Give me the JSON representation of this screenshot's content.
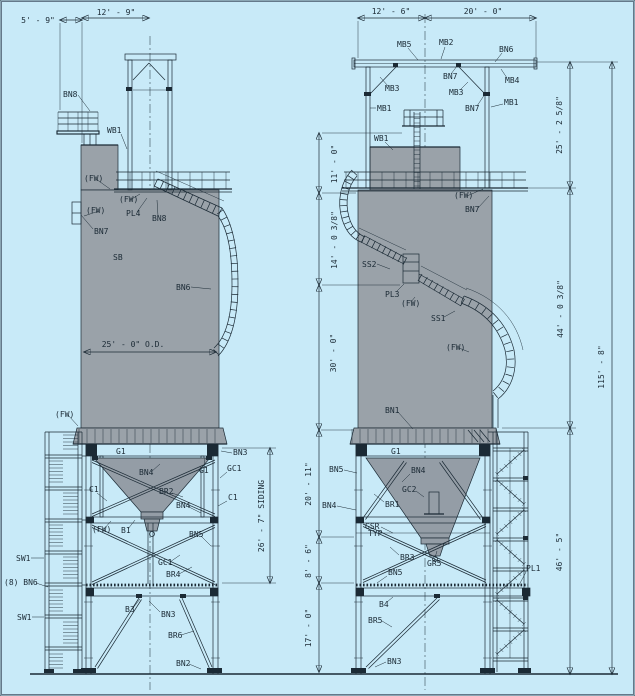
{
  "colors": {
    "background": "#c8eaf8",
    "ink": "#1b2a35",
    "silo_gray": "#9aa2a9",
    "hopper_gray": "#949da6"
  },
  "annotations": [
    {
      "t": "5' - 9\"",
      "x": 38,
      "y": 23,
      "a": "m"
    },
    {
      "t": "12' - 9\"",
      "x": 116,
      "y": 15,
      "a": "m"
    },
    {
      "t": "12' - 6\"",
      "x": 391,
      "y": 14,
      "a": "m"
    },
    {
      "t": "20' - 0\"",
      "x": 483,
      "y": 14,
      "a": "m"
    },
    {
      "t": "BN8",
      "x": 63,
      "y": 97,
      "l": [
        78,
        95,
        90,
        111
      ]
    },
    {
      "t": "WB1",
      "x": 107,
      "y": 133,
      "l": [
        121,
        134,
        127,
        149
      ]
    },
    {
      "t": "(FW)",
      "x": 84,
      "y": 181,
      "s": 6,
      "l": [
        96,
        179,
        110,
        189
      ]
    },
    {
      "t": "(FW)",
      "x": 119,
      "y": 202,
      "s": 6,
      "l": [
        130,
        200,
        140,
        194
      ]
    },
    {
      "t": "PL4",
      "x": 126,
      "y": 216,
      "l": [
        137,
        212,
        147,
        198
      ]
    },
    {
      "t": "BN8",
      "x": 152,
      "y": 221,
      "l": [
        158,
        216,
        157,
        200
      ]
    },
    {
      "t": "(FW)",
      "x": 86,
      "y": 213,
      "s": 6,
      "l": [
        99,
        211,
        84,
        216
      ]
    },
    {
      "t": "BN7",
      "x": 94,
      "y": 234,
      "l": [
        93,
        229,
        81,
        215
      ]
    },
    {
      "t": "SB",
      "x": 113,
      "y": 260
    },
    {
      "t": "BN6",
      "x": 176,
      "y": 290,
      "l": [
        191,
        287,
        211,
        289
      ]
    },
    {
      "t": "25' - 0\" O.D.",
      "x": 133,
      "y": 347,
      "a": "m"
    },
    {
      "t": "G1",
      "x": 116,
      "y": 454
    },
    {
      "t": "BN4",
      "x": 139,
      "y": 475,
      "l": [
        151,
        472,
        160,
        464
      ]
    },
    {
      "t": "G1",
      "x": 199,
      "y": 473,
      "l": [
        204,
        469,
        205,
        458
      ]
    },
    {
      "t": "GC1",
      "x": 227,
      "y": 471,
      "l": [
        227,
        472,
        220,
        478
      ]
    },
    {
      "t": "BN3",
      "x": 233,
      "y": 455,
      "l": [
        232,
        453,
        221,
        451
      ]
    },
    {
      "t": "C1",
      "x": 89,
      "y": 492,
      "l": [
        97,
        493,
        107,
        501
      ]
    },
    {
      "t": "BR2",
      "x": 159,
      "y": 494,
      "l": [
        172,
        493,
        183,
        497
      ]
    },
    {
      "t": "C1",
      "x": 228,
      "y": 500,
      "l": [
        227,
        501,
        218,
        506
      ]
    },
    {
      "t": "BN4",
      "x": 176,
      "y": 508,
      "l": [
        189,
        507,
        201,
        513
      ]
    },
    {
      "t": "(FW)",
      "x": 92,
      "y": 532,
      "s": 6,
      "l": [
        104,
        529,
        111,
        521
      ]
    },
    {
      "t": "B1",
      "x": 121,
      "y": 533,
      "l": [
        128,
        529,
        135,
        520
      ]
    },
    {
      "t": "BN5",
      "x": 189,
      "y": 537,
      "l": [
        201,
        536,
        211,
        546
      ]
    },
    {
      "t": "GC1",
      "x": 158,
      "y": 565,
      "l": [
        170,
        562,
        180,
        555
      ]
    },
    {
      "t": "BR4",
      "x": 166,
      "y": 577,
      "l": [
        179,
        574,
        192,
        567
      ]
    },
    {
      "t": "SW1",
      "x": 16,
      "y": 561,
      "l": [
        31,
        558,
        44,
        558
      ]
    },
    {
      "t": "(8) BN6",
      "x": 4,
      "y": 585,
      "l": [
        36,
        583,
        48,
        587
      ]
    },
    {
      "t": "SW1",
      "x": 17,
      "y": 620,
      "l": [
        32,
        617,
        44,
        617
      ]
    },
    {
      "t": "B3",
      "x": 125,
      "y": 612,
      "l": [
        133,
        608,
        140,
        599
      ]
    },
    {
      "t": "BN3",
      "x": 161,
      "y": 617,
      "l": [
        160,
        612,
        149,
        601
      ]
    },
    {
      "t": "BR6",
      "x": 168,
      "y": 638,
      "l": [
        181,
        635,
        194,
        631
      ]
    },
    {
      "t": "BN2",
      "x": 176,
      "y": 666,
      "l": [
        189,
        664,
        201,
        669
      ]
    },
    {
      "t": "(FW)",
      "x": 55,
      "y": 417,
      "s": 6,
      "l": [
        68,
        415,
        78,
        426
      ]
    },
    {
      "t": "26' - 7\" SIDING",
      "x": 264,
      "y": 516,
      "v": 1,
      "a": "m"
    },
    {
      "t": "MB5",
      "x": 397,
      "y": 47,
      "l": [
        408,
        48,
        418,
        60
      ]
    },
    {
      "t": "MB2",
      "x": 439,
      "y": 45,
      "l": [
        445,
        47,
        441,
        59
      ]
    },
    {
      "t": "BN6",
      "x": 499,
      "y": 52,
      "l": [
        502,
        53,
        495,
        62
      ]
    },
    {
      "t": "BN7",
      "x": 443,
      "y": 79,
      "l": [
        451,
        74,
        457,
        66
      ]
    },
    {
      "t": "MB3",
      "x": 385,
      "y": 91,
      "l": [
        388,
        86,
        380,
        77
      ]
    },
    {
      "t": "MB3",
      "x": 449,
      "y": 95,
      "l": [
        460,
        90,
        468,
        82
      ]
    },
    {
      "t": "MB4",
      "x": 505,
      "y": 83,
      "l": [
        507,
        78,
        501,
        69
      ]
    },
    {
      "t": "MB1",
      "x": 377,
      "y": 111,
      "l": [
        376,
        108,
        370,
        108
      ]
    },
    {
      "t": "MB1",
      "x": 504,
      "y": 105,
      "l": [
        503,
        104,
        491,
        107
      ]
    },
    {
      "t": "BN7",
      "x": 465,
      "y": 111,
      "l": [
        477,
        106,
        485,
        94
      ]
    },
    {
      "t": "WB1",
      "x": 374,
      "y": 141,
      "l": [
        385,
        142,
        393,
        150
      ]
    },
    {
      "t": "(FW)",
      "x": 454,
      "y": 198,
      "s": 6,
      "l": [
        467,
        196,
        483,
        189
      ]
    },
    {
      "t": "BN7",
      "x": 465,
      "y": 212,
      "l": [
        478,
        208,
        489,
        196
      ]
    },
    {
      "t": "SS2",
      "x": 362,
      "y": 267,
      "l": [
        377,
        264,
        390,
        269
      ]
    },
    {
      "t": "PL3",
      "x": 385,
      "y": 297,
      "l": [
        396,
        292,
        404,
        284
      ]
    },
    {
      "t": "(FW)",
      "x": 401,
      "y": 306,
      "s": 6,
      "l": [
        411,
        302,
        415,
        297
      ]
    },
    {
      "t": "SS1",
      "x": 431,
      "y": 321,
      "l": [
        444,
        317,
        455,
        311
      ]
    },
    {
      "t": "(FW)",
      "x": 446,
      "y": 350,
      "s": 6,
      "l": [
        459,
        348,
        469,
        352
      ]
    },
    {
      "t": "BN1",
      "x": 385,
      "y": 413,
      "l": [
        398,
        412,
        413,
        429
      ]
    },
    {
      "t": "G1",
      "x": 391,
      "y": 454
    },
    {
      "t": "BN5",
      "x": 329,
      "y": 472,
      "l": [
        344,
        470,
        357,
        473
      ]
    },
    {
      "t": "BN4",
      "x": 411,
      "y": 473,
      "l": [
        410,
        474,
        402,
        482
      ]
    },
    {
      "t": "GC2",
      "x": 402,
      "y": 492,
      "l": [
        416,
        491,
        424,
        497
      ]
    },
    {
      "t": "BN4",
      "x": 322,
      "y": 508,
      "l": [
        337,
        506,
        356,
        510
      ]
    },
    {
      "t": "BR1",
      "x": 385,
      "y": 507,
      "l": [
        384,
        502,
        374,
        494
      ]
    },
    {
      "t": "GSR",
      "x": 365,
      "y": 529,
      "l": [
        381,
        527,
        393,
        533
      ]
    },
    {
      "t": "TYP",
      "x": 368,
      "y": 536,
      "s": 5
    },
    {
      "t": "BR3",
      "x": 400,
      "y": 560,
      "l": [
        399,
        555,
        390,
        547
      ]
    },
    {
      "t": "GR5",
      "x": 427,
      "y": 566,
      "l": [
        434,
        561,
        437,
        551
      ]
    },
    {
      "t": "BN5",
      "x": 388,
      "y": 575,
      "l": [
        387,
        576,
        377,
        583
      ]
    },
    {
      "t": "PL1",
      "x": 526,
      "y": 571,
      "l": [
        526,
        572,
        518,
        587
      ]
    },
    {
      "t": "B4",
      "x": 379,
      "y": 607,
      "l": [
        387,
        602,
        393,
        597
      ]
    },
    {
      "t": "BR5",
      "x": 368,
      "y": 623,
      "l": [
        382,
        621,
        392,
        627
      ]
    },
    {
      "t": "BN3",
      "x": 387,
      "y": 664,
      "l": [
        386,
        662,
        375,
        667
      ]
    },
    {
      "t": "11' - 0\"",
      "x": 337,
      "y": 164,
      "v": 1,
      "a": "m"
    },
    {
      "t": "14' - 0 3/8\"",
      "x": 337,
      "y": 240,
      "v": 1,
      "a": "m"
    },
    {
      "t": "30' - 0\"",
      "x": 336,
      "y": 353,
      "v": 1,
      "a": "m"
    },
    {
      "t": "20' - 11\"",
      "x": 311,
      "y": 484,
      "v": 1,
      "a": "m"
    },
    {
      "t": "8' - 6\"",
      "x": 311,
      "y": 561,
      "v": 1,
      "a": "m"
    },
    {
      "t": "17' - 0\"",
      "x": 311,
      "y": 628,
      "v": 1,
      "a": "m"
    },
    {
      "t": "25' - 2 5/8\"",
      "x": 562,
      "y": 125,
      "v": 1,
      "a": "m"
    },
    {
      "t": "44' - 0 3/8\"",
      "x": 563,
      "y": 309,
      "v": 1,
      "a": "m"
    },
    {
      "t": "46' - 5\"",
      "x": 562,
      "y": 552,
      "v": 1,
      "a": "m"
    },
    {
      "t": "115' - 8\"",
      "x": 604,
      "y": 367,
      "v": 1,
      "a": "m"
    }
  ]
}
